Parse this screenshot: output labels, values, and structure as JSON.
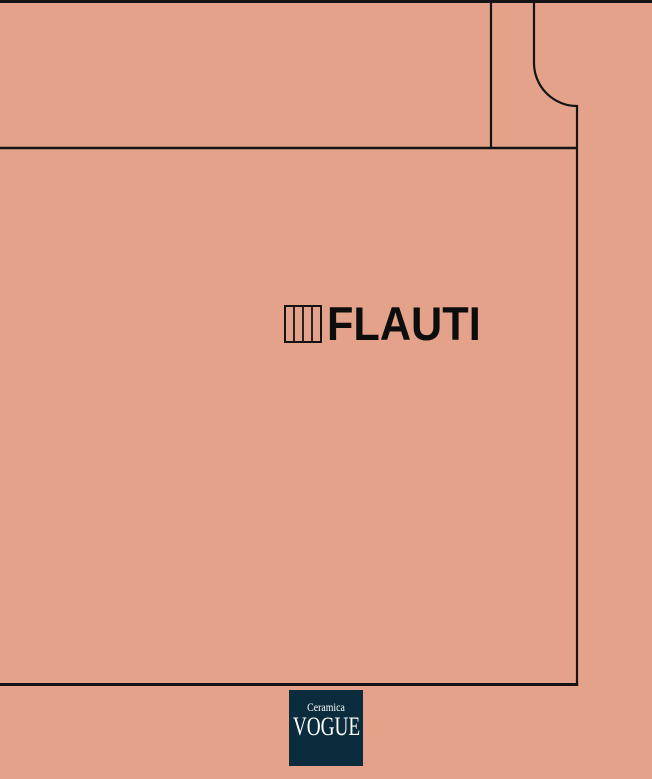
{
  "cover": {
    "series_title": "FLAUTI"
  },
  "brand": {
    "name_top": "Ceramica",
    "name_main": "VOGUE"
  },
  "icons": {
    "series_icon": "vertical-bars-tile-icon"
  },
  "colors": {
    "background": "#e3a289",
    "line": "#141414",
    "brand_box": "#0b2c3c",
    "brand_text": "#ffffff",
    "title_text": "#0d0d0d"
  }
}
